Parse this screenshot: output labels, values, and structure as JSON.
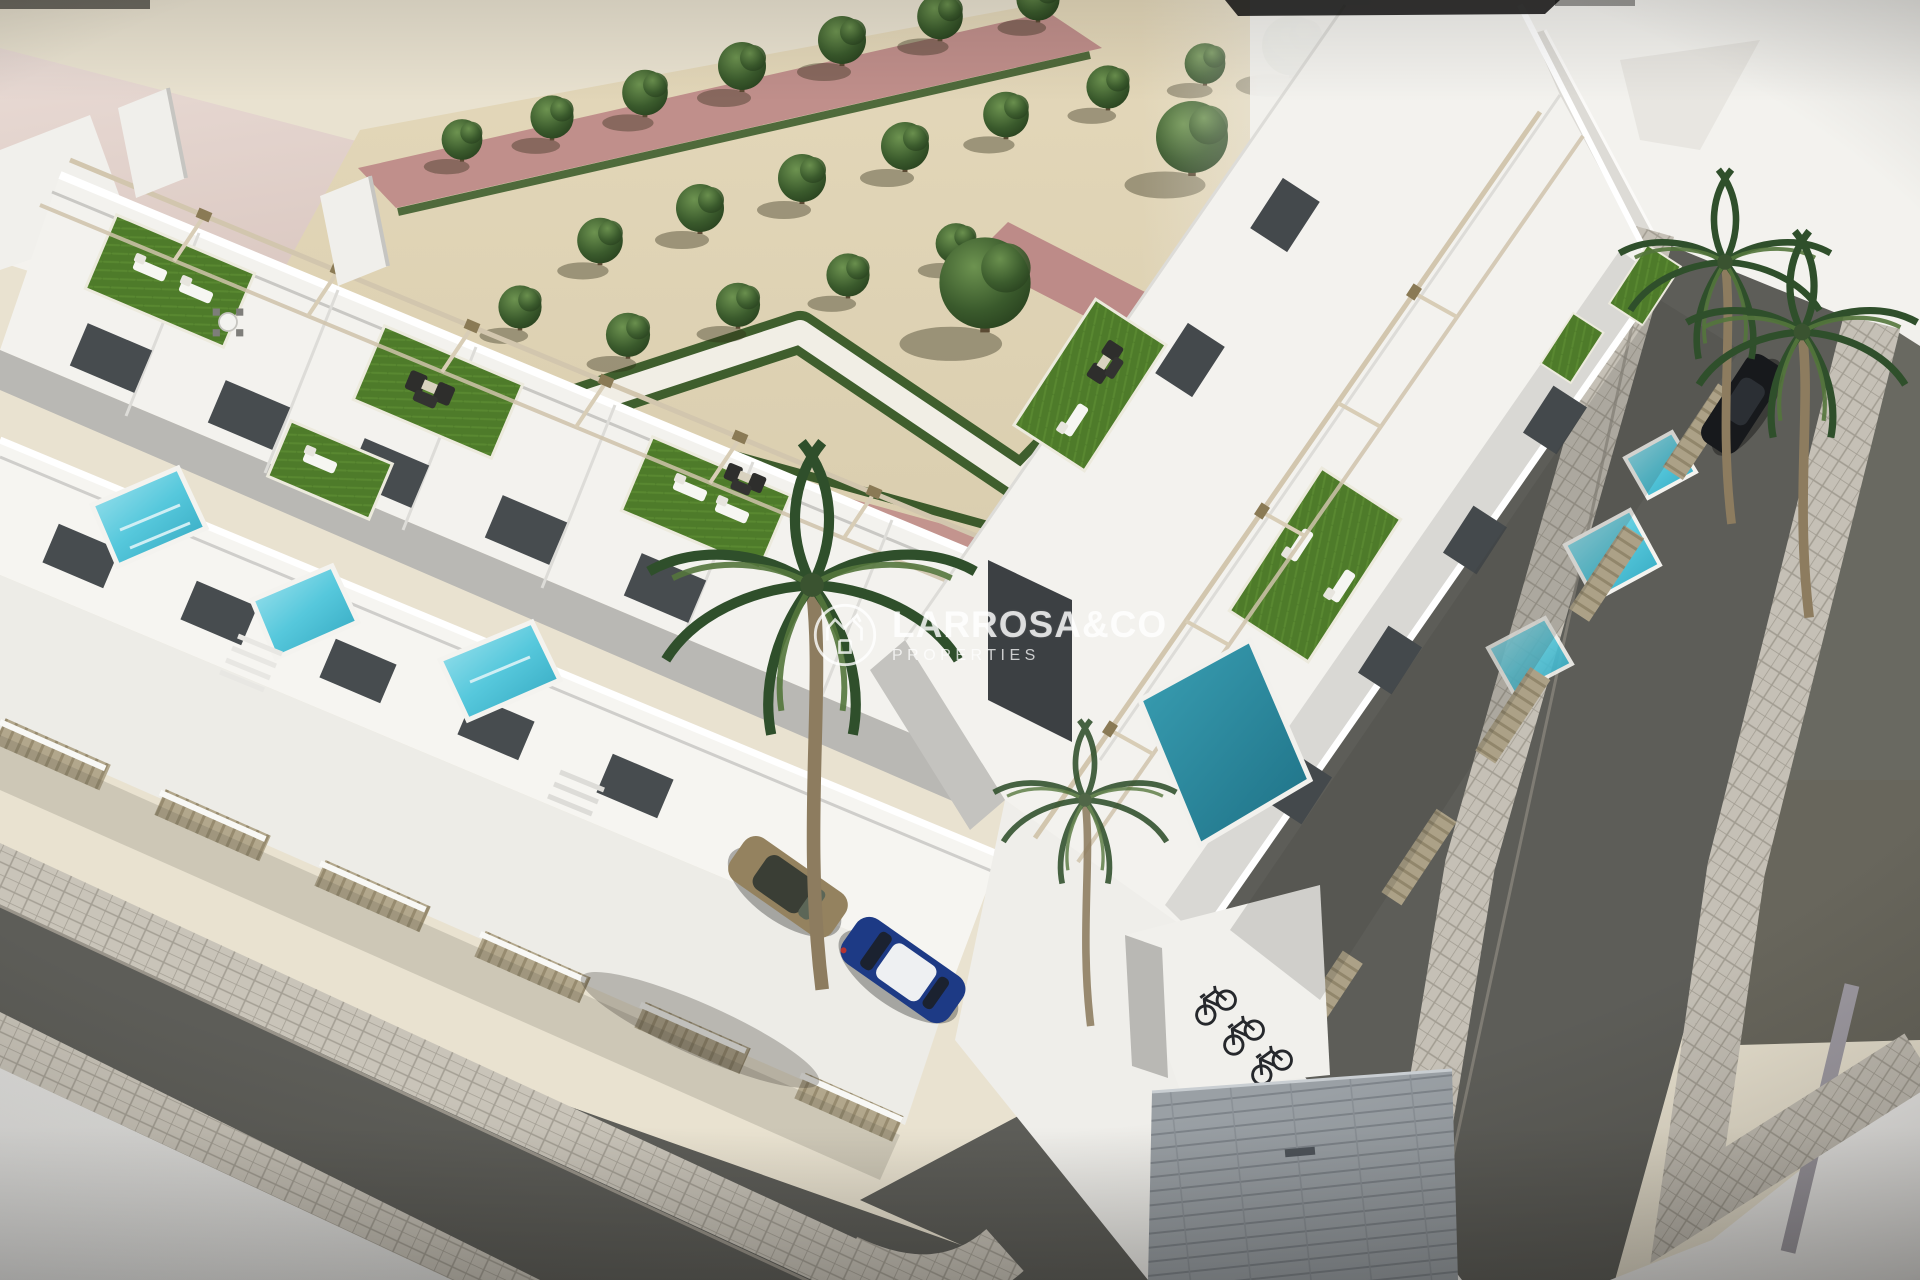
{
  "watermark": {
    "brand": "LARROSA&CO",
    "tagline": "PROPERTIES",
    "logo_icon": "house-crown-monogram-icon",
    "color": "#ffffff",
    "opacity": 0.78
  },
  "scene": {
    "type": "3D architectural rendering, aerial corner view",
    "caption": "Modern white two-storey townhouse development wrapping a street corner, with rooftop solarium terraces (artificial lawn, sun loungers, wicker sofas, pergolas), private plunge pools behind beige slatted fences, a landscaped park with sculpted hedges and rows of trees, palm trees, parked cars, a bicycle shelter and grey asphalt streets with paved sidewalks.",
    "inventory": {
      "townhouse_wings": 2,
      "rooftop_lawn_terraces": 8,
      "private_pools": 7,
      "parked_cars": 3,
      "bicycles": 3,
      "palm_trees": 4,
      "park_trees": 23
    }
  },
  "palette": {
    "sand": "#e9e2d0",
    "park_gravel": "#ded3b6",
    "path_pink": "#c08f8b",
    "hedge_green": "#3f5e2d",
    "lawn_green": "#4e7b2a",
    "building_white": "#f3f2ee",
    "facade_shadow": "#c9c8c4",
    "glass_dark": "#474c4f",
    "asphalt": "#5d5d58",
    "sidewalk_paver": "#c9c4b9",
    "plaza_light": "#efeeec",
    "pool_turquoise": "#5ec9da",
    "pool_deep_teal": "#2a8ba1",
    "fence_beige": "#b2a78c",
    "pergola_beam": "#d2c6ae",
    "car_tan": "#94825f",
    "car_blue": "#1d3a85",
    "car_dark": "#17191c"
  }
}
